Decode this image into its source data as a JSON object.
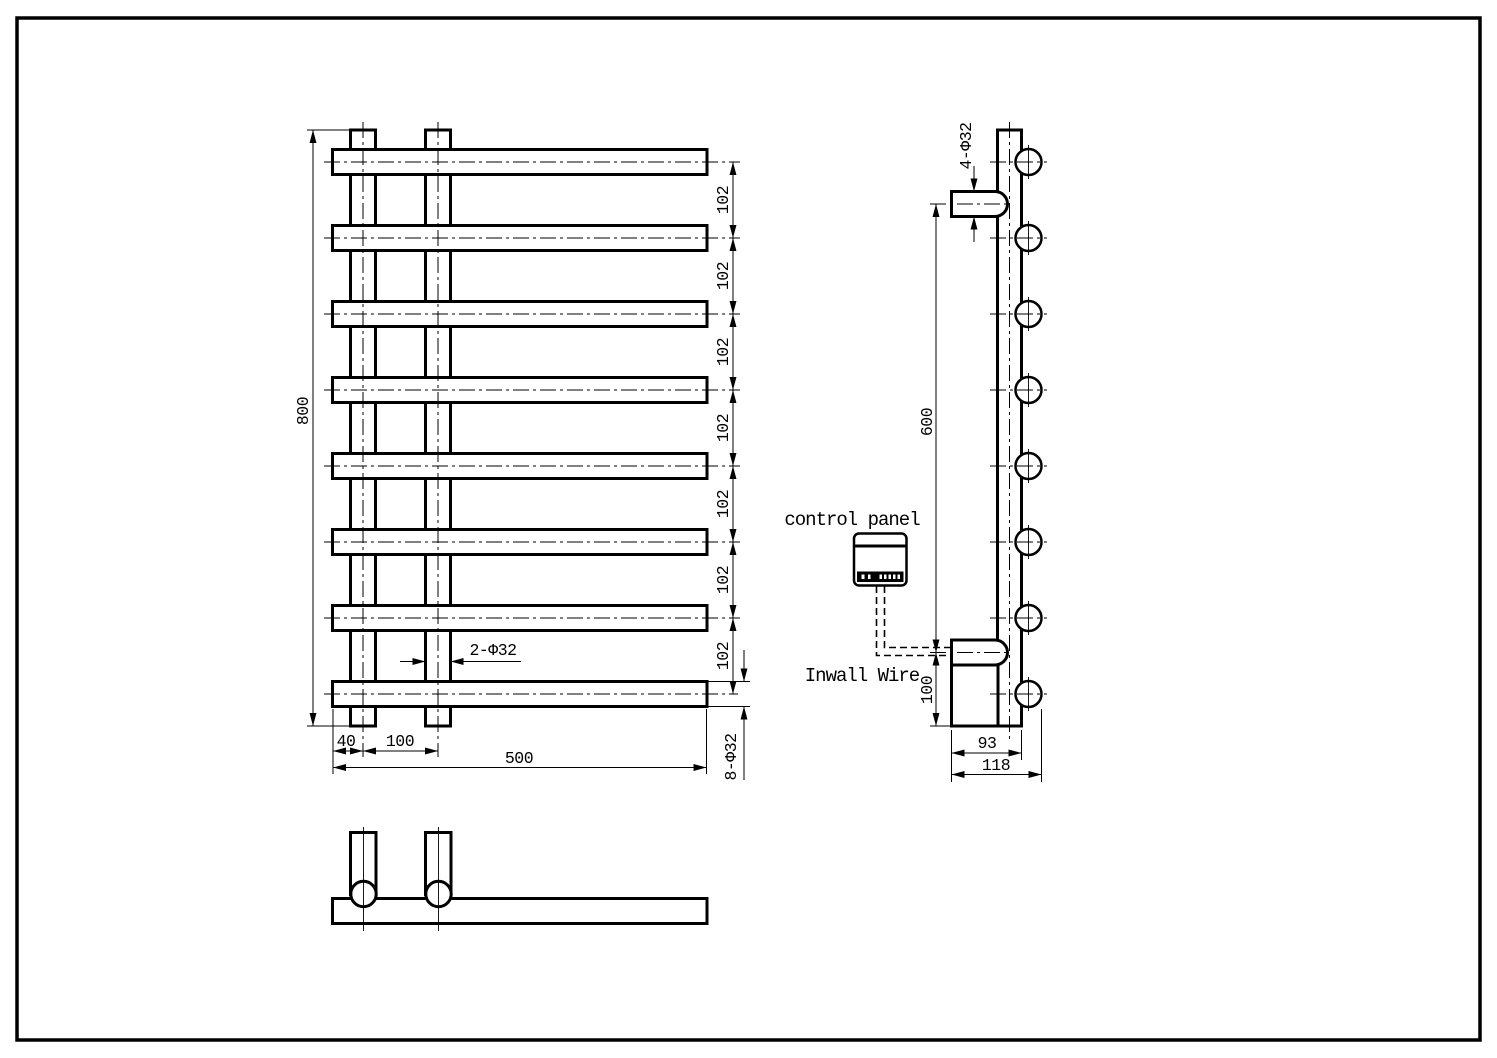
{
  "labels": {
    "control_panel": "control panel",
    "inwall_wire": "Inwall Wire"
  },
  "front_view": {
    "dim_height": "800",
    "dim_spacing": [
      "102",
      "102",
      "102",
      "102",
      "102",
      "102",
      "102"
    ],
    "dim_post_tubes": "2-Φ32",
    "dim_bar_overhang": "40",
    "dim_post_gap": "100",
    "dim_width": "500",
    "dim_bar_tubes": "8-Φ32"
  },
  "side_view": {
    "dim_bracket_tubes": "4-Φ32",
    "dim_bracket_span": "600",
    "dim_heater_height": "100",
    "dim_body_depth": "93",
    "dim_total_depth": "118"
  }
}
